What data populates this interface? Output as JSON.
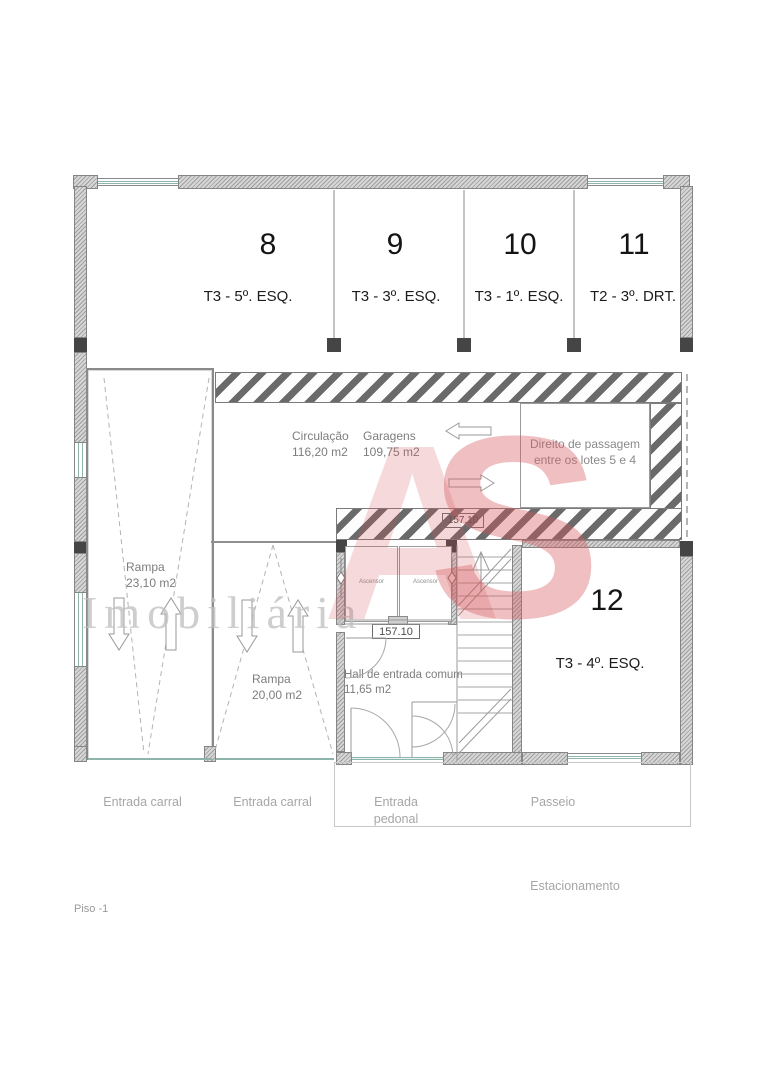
{
  "meta": {
    "floor_label": "Piso -1"
  },
  "watermark": {
    "logo_a": "A",
    "logo_s": "S",
    "text": "Imobiliária",
    "red": "#d5565c",
    "gray": "#cdcdcd"
  },
  "colors": {
    "window_teal": "#8fb4ac",
    "stripe_gray": "#6a6a6a",
    "wall_gray": "#d6d6d6"
  },
  "parking_spaces": [
    {
      "number": "8",
      "assignment": "T3 - 5º. ESQ."
    },
    {
      "number": "9",
      "assignment": "T3 - 3º. ESQ."
    },
    {
      "number": "10",
      "assignment": "T3 - 1º. ESQ."
    },
    {
      "number": "11",
      "assignment": "T2 - 3º. DRT."
    },
    {
      "number": "12",
      "assignment": "T3 - 4º. ESQ."
    }
  ],
  "rooms": {
    "circulacao": {
      "name": "Circulação",
      "area": "116,20 m2"
    },
    "garagens": {
      "name": "Garagens",
      "area": "109,75 m2"
    },
    "rampa_esq": {
      "name": "Rampa",
      "area": "23,10 m2"
    },
    "rampa_centro": {
      "name": "Rampa",
      "area": "20,00 m2"
    },
    "hall": {
      "name": "Hall de entrada comum",
      "area": "11,65 m2"
    }
  },
  "notes": {
    "direito_line1": "Direito de passagem",
    "direito_line2": "entre os lotes 5 e 4"
  },
  "levels": {
    "cota_superior": "157.10",
    "cota_inferior": "157.10"
  },
  "elevators": {
    "left": "Ascensor",
    "right": "Ascensor"
  },
  "exterior_labels": {
    "entrada_carral_1": "Entrada carral",
    "entrada_carral_2": "Entrada carral",
    "entrada_pedonal": "Entrada pedonal",
    "passeio": "Passeio",
    "estacionamento": "Estacionamento"
  }
}
